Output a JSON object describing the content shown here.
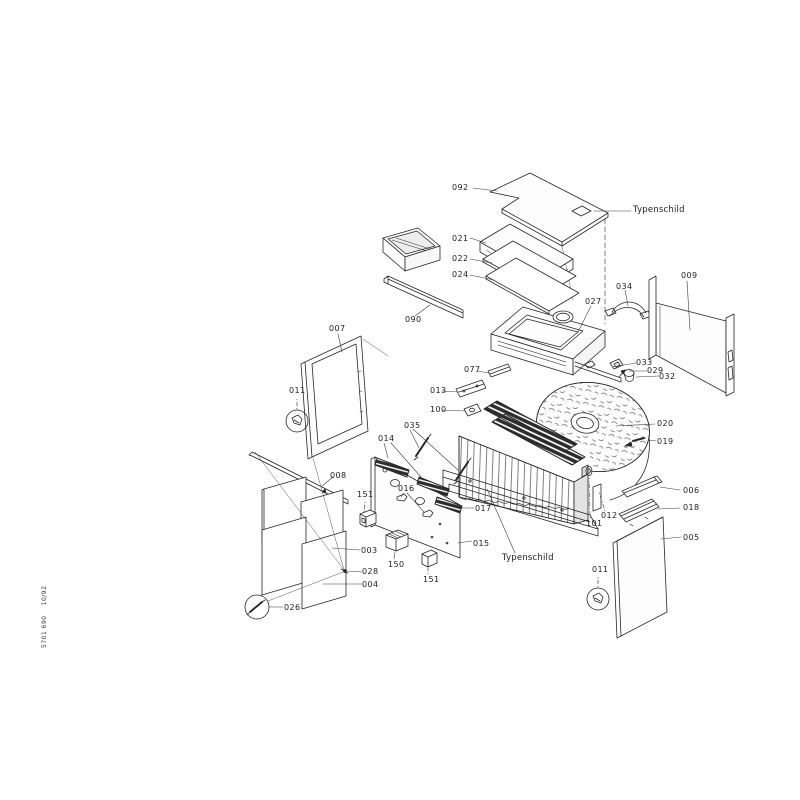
{
  "document": {
    "type_label": "Typenschild",
    "doc_number": "5701 690",
    "doc_revision": "10/92"
  },
  "diagram": {
    "kind": "exploded-parts-view",
    "line_color": "#262626",
    "background": "#ffffff"
  },
  "parts": {
    "003": "003",
    "004": "004",
    "005": "005",
    "006": "006",
    "007": "007",
    "008": "008",
    "009": "009",
    "011": "011",
    "012": "012",
    "013": "013",
    "014": "014",
    "015": "015",
    "016": "016",
    "017": "017",
    "018": "018",
    "019": "019",
    "020": "020",
    "021": "021",
    "022": "022",
    "024": "024",
    "026": "026",
    "027": "027",
    "028": "028",
    "029": "029",
    "032": "032",
    "033": "033",
    "034": "034",
    "035": "035",
    "077": "077",
    "090": "090",
    "092": "092",
    "100": "100",
    "101": "101",
    "150": "150",
    "151": "151"
  }
}
